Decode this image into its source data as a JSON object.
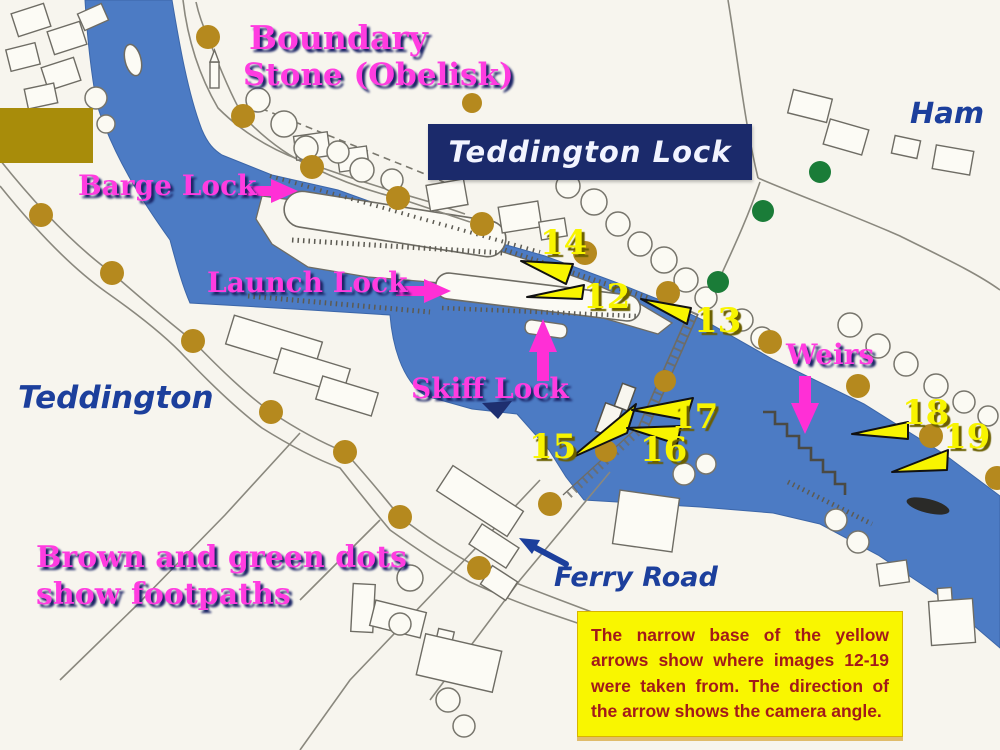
{
  "title_box": {
    "label": "Teddington Lock"
  },
  "place_labels": {
    "teddington": "Teddington",
    "ham": "Ham",
    "ferry_road": "Ferry Road"
  },
  "feature_labels": {
    "boundary_line1": "Boundary",
    "boundary_line2": "Stone (Obelisk)",
    "barge_lock": "Barge Lock",
    "launch_lock": "Launch Lock",
    "skiff_lock": "Skiff Lock",
    "weirs": "Weirs"
  },
  "legend": {
    "footpaths_line1": "Brown and green dots",
    "footpaths_line2": "show footpaths",
    "info_note": "The narrow base of the yellow arrows show where images 12-19 were taken from. The direction of the arrow shows the camera angle."
  },
  "camera_points": [
    {
      "label": "12",
      "x": 527,
      "y": 297
    },
    {
      "label": "13",
      "x": 641,
      "y": 299
    },
    {
      "label": "14",
      "x": 521,
      "y": 261
    },
    {
      "label": "15",
      "x": 571,
      "y": 458
    },
    {
      "label": "16",
      "x": 627,
      "y": 428
    },
    {
      "label": "17",
      "x": 632,
      "y": 410
    },
    {
      "label": "18",
      "x": 852,
      "y": 434
    },
    {
      "label": "19",
      "x": 892,
      "y": 472
    }
  ],
  "colors": {
    "river_blue": "#4c7bc4",
    "footpath_brown": "#b5891e",
    "footpath_green": "#1a7c38",
    "label_magenta": "#ff3ce0",
    "camera_arrow_yellow": "#f8f400",
    "title_box_navy": "#1b2a6b",
    "handwriting_navy": "#1c3f9c",
    "info_text_red": "#a21a1a",
    "info_box_yellow": "#f9f600",
    "gold_bar": "#a88c0a"
  }
}
